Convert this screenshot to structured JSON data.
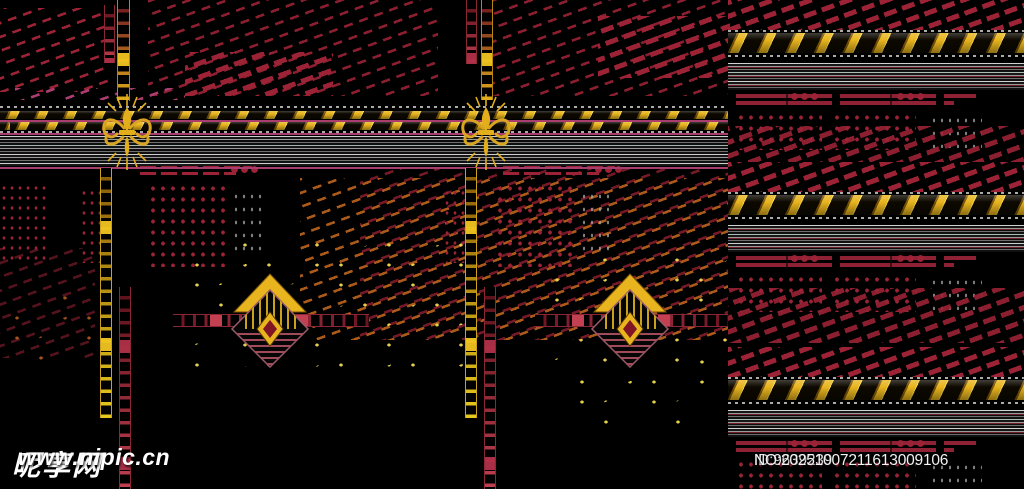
{
  "watermark": {
    "site_name": "昵享网",
    "site_url": "www.nipic.cn",
    "image_id": "ID:9639239",
    "serial_no": "NO:20251007211613009106"
  },
  "palette": {
    "background": "#000000",
    "gold": "#e2ae1b",
    "gold_deep": "#8a5f0a",
    "crimson": "#9b2335",
    "red_bright": "#c2452f",
    "orange": "#c96a1e",
    "magenta": "#a83d6e",
    "silver": "#a8aca8",
    "teal": "#7fa393",
    "yellow_speck": "#e4cf4a",
    "white": "#ffffff"
  },
  "artwork": {
    "ornaments": [
      "fleur-de-lis",
      "diamond-medallion",
      "hazard-band",
      "ladder-strip",
      "dot-grid",
      "diagonal-streaks",
      "pinstripe-band"
    ]
  }
}
